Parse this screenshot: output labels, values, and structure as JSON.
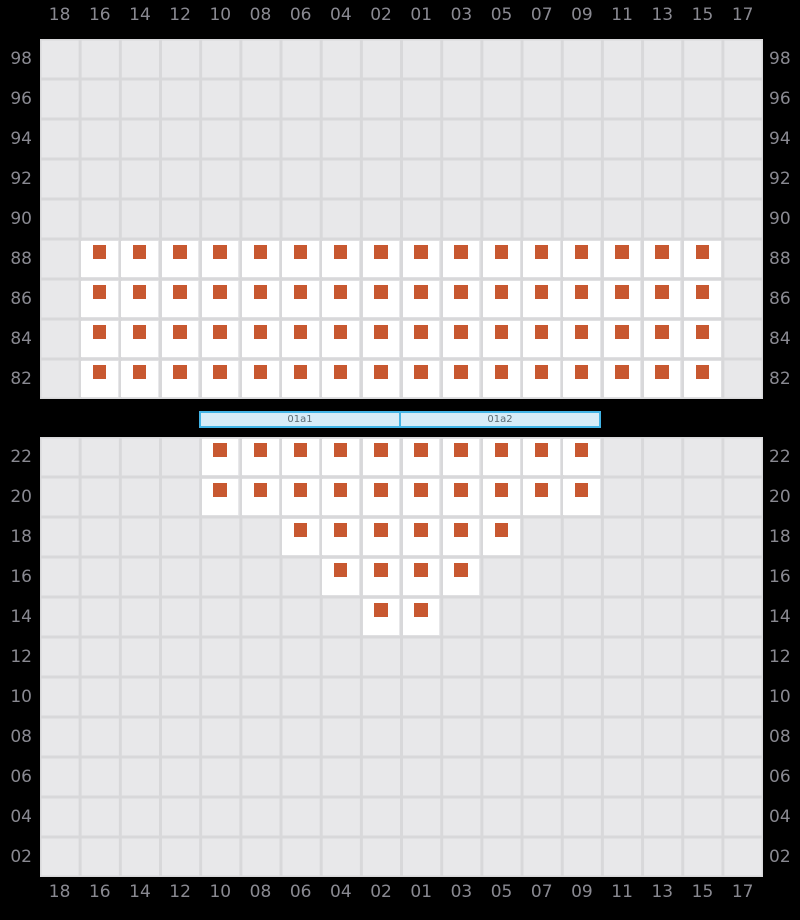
{
  "axes": {
    "columns": [
      "18",
      "16",
      "14",
      "12",
      "10",
      "08",
      "06",
      "04",
      "02",
      "01",
      "03",
      "05",
      "07",
      "09",
      "11",
      "13",
      "15",
      "17"
    ],
    "upper_rows": [
      "98",
      "96",
      "94",
      "92",
      "90",
      "88",
      "86",
      "84",
      "82"
    ],
    "lower_rows": [
      "22",
      "20",
      "18",
      "16",
      "14",
      "12",
      "10",
      "08",
      "06",
      "04",
      "02"
    ]
  },
  "stage": {
    "segments": [
      {
        "label": "01a1"
      },
      {
        "label": "01a2"
      }
    ]
  },
  "seating": {
    "upper": [
      {
        "row": "88",
        "columns": [
          "16",
          "14",
          "12",
          "10",
          "08",
          "06",
          "04",
          "02",
          "01",
          "03",
          "05",
          "07",
          "09",
          "11",
          "13",
          "15"
        ]
      },
      {
        "row": "86",
        "columns": [
          "16",
          "14",
          "12",
          "10",
          "08",
          "06",
          "04",
          "02",
          "01",
          "03",
          "05",
          "07",
          "09",
          "11",
          "13",
          "15"
        ]
      },
      {
        "row": "84",
        "columns": [
          "16",
          "14",
          "12",
          "10",
          "08",
          "06",
          "04",
          "02",
          "01",
          "03",
          "05",
          "07",
          "09",
          "11",
          "13",
          "15"
        ]
      },
      {
        "row": "82",
        "columns": [
          "16",
          "14",
          "12",
          "10",
          "08",
          "06",
          "04",
          "02",
          "01",
          "03",
          "05",
          "07",
          "09",
          "11",
          "13",
          "15"
        ]
      }
    ],
    "lower": [
      {
        "row": "22",
        "columns": [
          "10",
          "08",
          "06",
          "04",
          "02",
          "01",
          "03",
          "05",
          "07",
          "09"
        ]
      },
      {
        "row": "20",
        "columns": [
          "10",
          "08",
          "06",
          "04",
          "02",
          "01",
          "03",
          "05",
          "07",
          "09"
        ]
      },
      {
        "row": "18",
        "columns": [
          "06",
          "04",
          "02",
          "01",
          "03",
          "05"
        ]
      },
      {
        "row": "16",
        "columns": [
          "04",
          "02",
          "01",
          "03"
        ]
      },
      {
        "row": "14",
        "columns": [
          "02",
          "01"
        ]
      }
    ]
  },
  "colors": {
    "background": "#000000",
    "grid_fill": "#e8e8ea",
    "grid_line": "#d8d8da",
    "axis_label": "#898991",
    "seat_cell": "#ffffff",
    "seat_marker": "#c85830",
    "stage_fill": "#d6ecf8",
    "stage_border": "#42b4e6",
    "stage_label": "#5a6a72"
  }
}
